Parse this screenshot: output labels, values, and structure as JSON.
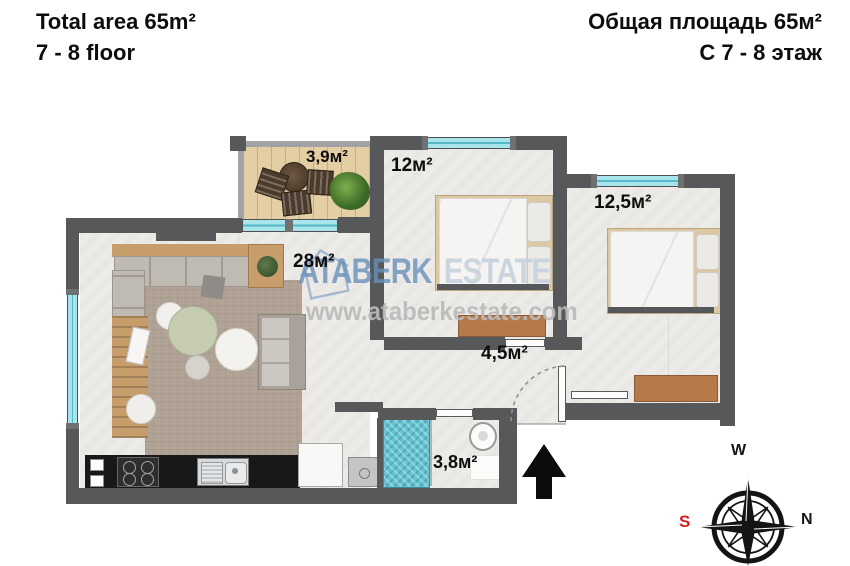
{
  "header": {
    "left_line1": "Total area 65m²",
    "left_line2": "7 - 8 floor",
    "right_line1": "Общая площадь 65м²",
    "right_line2": "С 7 - 8 этаж"
  },
  "rooms": {
    "balcony": "3,9м²",
    "bedroom1": "12м²",
    "bedroom2": "12,5м²",
    "living": "28м²",
    "hallway": "4,5м²",
    "bathroom": "3,8м²"
  },
  "watermark": {
    "brand1": "ATABERK",
    "brand2": "ESTATE",
    "url": "www.ataberkestate.com"
  },
  "compass": {
    "top": "W",
    "right": "N",
    "left": "S"
  },
  "icons": {
    "entrance": "up-arrow",
    "compass": "compass-rose",
    "watermark_logo": "house-outline"
  },
  "colors": {
    "wall": "#57585a",
    "window": "#a7e4ec",
    "balcony_floor": "#e4cfa5",
    "shower_tile": "#62c3d2",
    "wood": "#b5794a",
    "rug": "#b1a496",
    "accent_red": "#d61f1f",
    "watermark_blue": "#6a92bc"
  }
}
